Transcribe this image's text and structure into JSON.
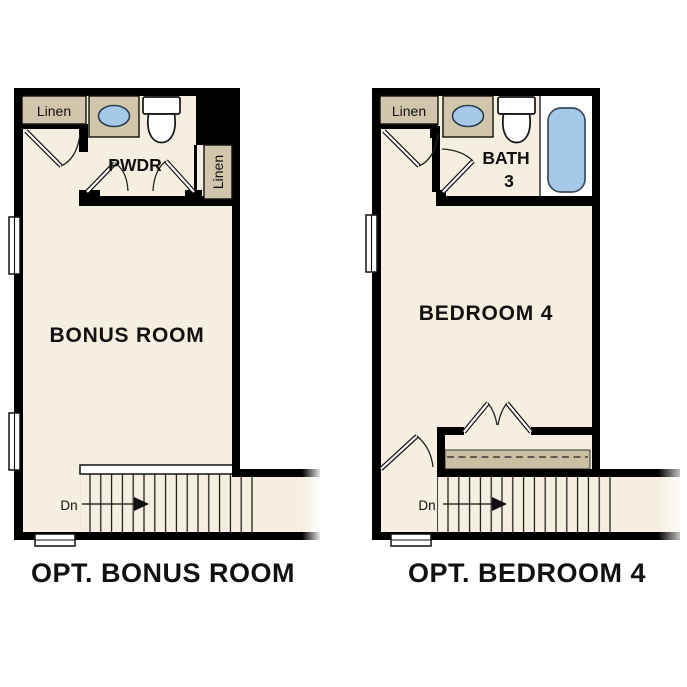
{
  "colors": {
    "background": "#ffffff",
    "wall": "#000000",
    "floor": "#f5efe2",
    "cabinet": "#d1c5ab",
    "shelf": "#cbbfa3",
    "fixture_blue": "#a6c9e9",
    "text": "#111111"
  },
  "plans": {
    "bonus": {
      "caption": "OPT. BONUS ROOM",
      "room_label": "BONUS ROOM",
      "linen_top": "Linen",
      "linen_side": "Linen",
      "powder_label": "PWDR",
      "stair_label": "Dn"
    },
    "bedroom": {
      "caption": "OPT. BEDROOM 4",
      "room_label": "BEDROOM 4",
      "linen": "Linen",
      "bath_label_line1": "BATH",
      "bath_label_line2": "3",
      "stair_label": "Dn"
    }
  }
}
